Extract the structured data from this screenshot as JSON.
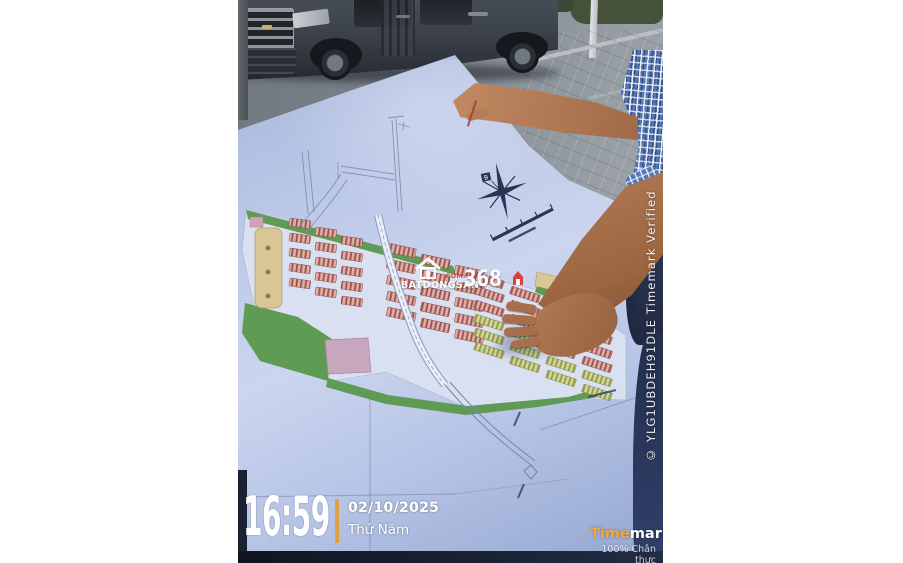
{
  "watermarks": {
    "timestamp": {
      "time": "16:59",
      "date": "02/10/2025",
      "weekday": "Thứ Năm"
    },
    "timemark": {
      "brand_highlight": "Time",
      "brand_rest": "mark",
      "tagline": "100% Chân thực"
    },
    "verification": "© YLG1UBDEH91DLE Timemark Verified",
    "listing_brand": {
      "name": "BATDONGSAN",
      "number": "368",
      "domain": ".COM.VN"
    }
  },
  "site_plan": {
    "compass_north_label": "B"
  },
  "colors": {
    "timestamp_accent": "#DFA23F",
    "timemark_yellow": "#F2A93B",
    "brand_red": "#E0392E",
    "plan_green": "#5F9B55",
    "plan_lot_pink": "#C98A82",
    "plan_lot_yellow": "#CFD190",
    "plan_tan": "#D8C794",
    "paper_blue": "#B7C4E5"
  }
}
